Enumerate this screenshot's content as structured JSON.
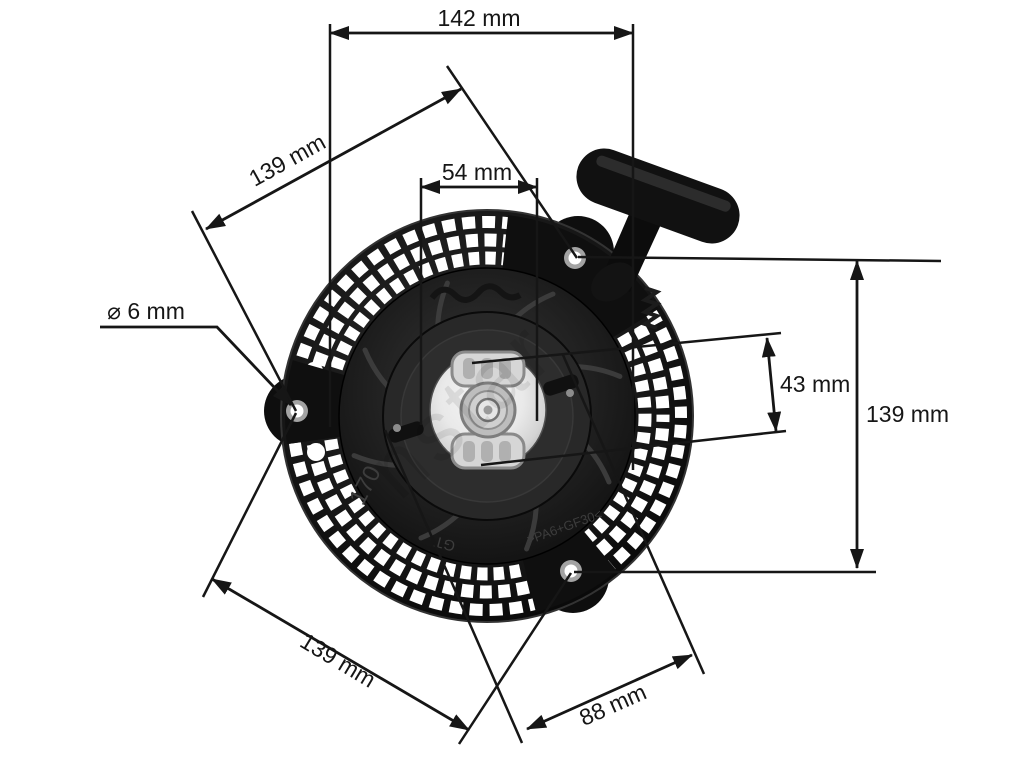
{
  "diagram": {
    "subject": "recoil-starter-dimension-drawing",
    "units": "mm",
    "dimensions": {
      "overall_width_top": "142 mm",
      "hole_pitch_upper_left": "139 mm",
      "hub_width": "54 mm",
      "mount_hole_diameter": "⌀ 6 mm",
      "hub_height": "43 mm",
      "overall_height_right": "139 mm",
      "hole_pitch_lower_left": "139 mm",
      "hole_offset_bottom": "88 mm"
    },
    "part_markings": {
      "casting_number": "170",
      "material_code": ">PA6+GF30<",
      "brand_stamp": "GT"
    },
    "watermark_text": "nstar",
    "line_color": "#161616",
    "background_color": "#ffffff"
  }
}
